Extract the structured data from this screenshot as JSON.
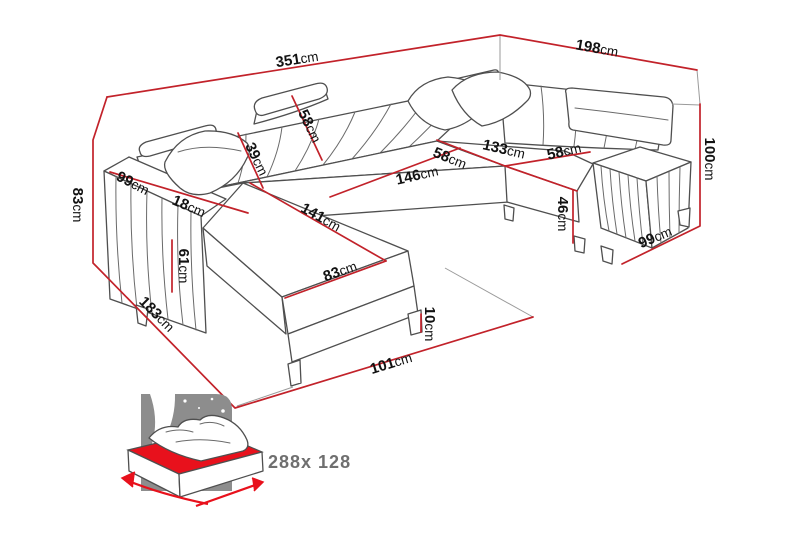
{
  "diagram": {
    "kind": "furniture-dimension-diagram",
    "subject": "U-shaped corner sofa bed",
    "unit": "cm"
  },
  "colors": {
    "dimension_line": "#c2222a",
    "sofa_outline": "#4f4f4f",
    "label_text": "#121212",
    "bed_accent_red": "#e8111c",
    "bed_panel_gray": "#8d8d8d",
    "bed_size_text": "#6f6f6f"
  },
  "dimensions": [
    {
      "id": "total-width-back",
      "value": "351",
      "unit": "cm"
    },
    {
      "id": "total-depth-right",
      "value": "198",
      "unit": "cm"
    },
    {
      "id": "left-back-height",
      "value": "83",
      "unit": "cm"
    },
    {
      "id": "left-arm-depth",
      "value": "99",
      "unit": "cm"
    },
    {
      "id": "left-arm-width",
      "value": "18",
      "unit": "cm"
    },
    {
      "id": "left-seat-height",
      "value": "61",
      "unit": "cm"
    },
    {
      "id": "chaise-side-depth",
      "value": "183",
      "unit": "cm"
    },
    {
      "id": "backrest-with-headrest-height",
      "value": "58",
      "unit": "cm"
    },
    {
      "id": "backrest-height",
      "value": "39",
      "unit": "cm"
    },
    {
      "id": "center-seat-width",
      "value": "146",
      "unit": "cm"
    },
    {
      "id": "chaise-length",
      "value": "141",
      "unit": "cm"
    },
    {
      "id": "chaise-width",
      "value": "83",
      "unit": "cm"
    },
    {
      "id": "seat-depth-left",
      "value": "58",
      "unit": "cm"
    },
    {
      "id": "right-section-width",
      "value": "133",
      "unit": "cm"
    },
    {
      "id": "seat-depth-right",
      "value": "58",
      "unit": "cm"
    },
    {
      "id": "seat-height",
      "value": "46",
      "unit": "cm"
    },
    {
      "id": "total-height",
      "value": "100",
      "unit": "cm"
    },
    {
      "id": "right-arm-depth",
      "value": "99",
      "unit": "cm"
    },
    {
      "id": "leg-height",
      "value": "10",
      "unit": "cm"
    },
    {
      "id": "front-opening-width",
      "value": "101",
      "unit": "cm"
    }
  ],
  "sleeping_area": {
    "icon": "sofa-bed-icon",
    "label": "288x 128"
  }
}
